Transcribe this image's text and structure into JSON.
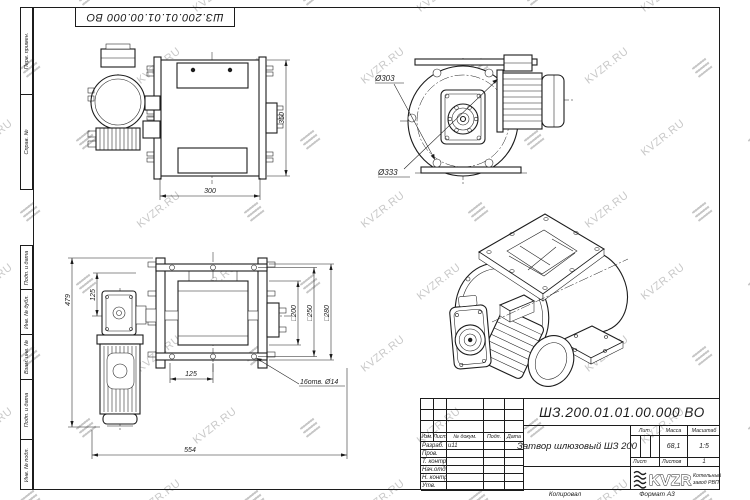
{
  "sheet": {
    "top_doc_number": "ШЗ.200.01.01.00.000 ВО",
    "watermark_text": "KVZR.RU",
    "footer": {
      "copied_label": "Копировал",
      "format_label": "Формат А3"
    },
    "colors": {
      "line": "#1c1c1c",
      "watermark": "#c9c9c9",
      "paper": "#ffffff"
    }
  },
  "margin": {
    "labels": [
      "Перв. примен.",
      "Справ. №",
      "",
      "Подп. и дата",
      "Инв. № дубл.",
      "Взам. инв. №",
      "Подп. и дата",
      "Инв. № подл."
    ]
  },
  "title_block": {
    "doc_number": "ШЗ.200.01.01.00.000 ВО",
    "title": "Затвор шлюзовый ШЗ 200",
    "header_cols": [
      "Изм.",
      "Лист",
      "№ докум.",
      "Подп.",
      "Дата"
    ],
    "rows": [
      {
        "label": "Разраб.",
        "value": "и11"
      },
      {
        "label": "Пров.",
        "value": ""
      },
      {
        "label": "Т. контр.",
        "value": ""
      },
      {
        "label": "Нач.отд.",
        "value": ""
      },
      {
        "label": "Н. контр.",
        "value": ""
      },
      {
        "label": "Утв.",
        "value": ""
      }
    ],
    "lit_label": "Лит.",
    "mass_label": "Масса",
    "scale_label": "Масштаб",
    "mass_value": "68,1",
    "scale_value": "1:5",
    "sheet_label": "Лист",
    "sheets_label": "Листов",
    "sheets_value": "1",
    "company": {
      "logo_text": "KVZR",
      "name_line1": "Котельный",
      "name_line2": "завод РВП"
    }
  },
  "views": {
    "side_view": {
      "dim_width": "300",
      "dim_height": "350"
    },
    "end_view": {
      "dim_bolt_circle": "Ø303",
      "dim_outer": "Ø333"
    },
    "front_view": {
      "dim_gear_offset": "125",
      "dim_total_height": "479",
      "dim_hole_spacing": "125",
      "dim_total_width": "554",
      "dim_sq200": "□200",
      "dim_sq250": "□250",
      "dim_sq280": "□280",
      "holes_note": "16отв. Ø14"
    }
  }
}
